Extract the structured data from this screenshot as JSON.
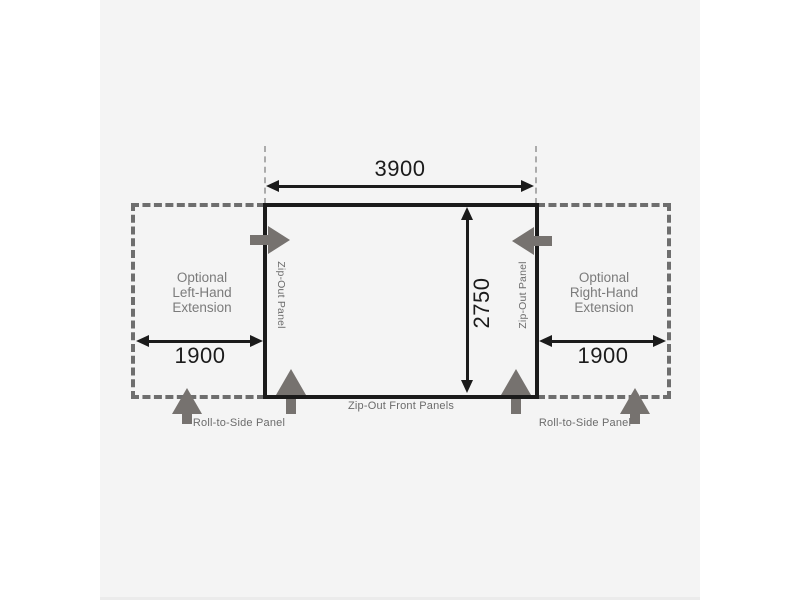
{
  "diagram": {
    "main_width_mm": "3900",
    "main_depth_mm": "2750",
    "left_extension": {
      "lines": [
        "Optional",
        "Left-Hand",
        "Extension"
      ],
      "width_mm": "1900"
    },
    "right_extension": {
      "lines": [
        "Optional",
        "Right-Hand",
        "Extension"
      ],
      "width_mm": "1900"
    },
    "zip_out_panel_left": "Zip-Out Panel",
    "zip_out_panel_right": "Zip-Out Panel",
    "zip_out_front": "Zip-Out Front Panels",
    "roll_to_side_left": "Roll-to-Side Panel",
    "roll_to_side_right": "Roll-to-Side Panel",
    "colors": {
      "panel_background": "#f4f4f4",
      "line_black": "#1b1b1b",
      "dashed_gray": "#6e6e6e",
      "guide_gray": "#ababab",
      "label_gray": "#7b7b7b",
      "small_label_gray": "#6b6b6b",
      "arrow_gray": "#76726f"
    }
  }
}
